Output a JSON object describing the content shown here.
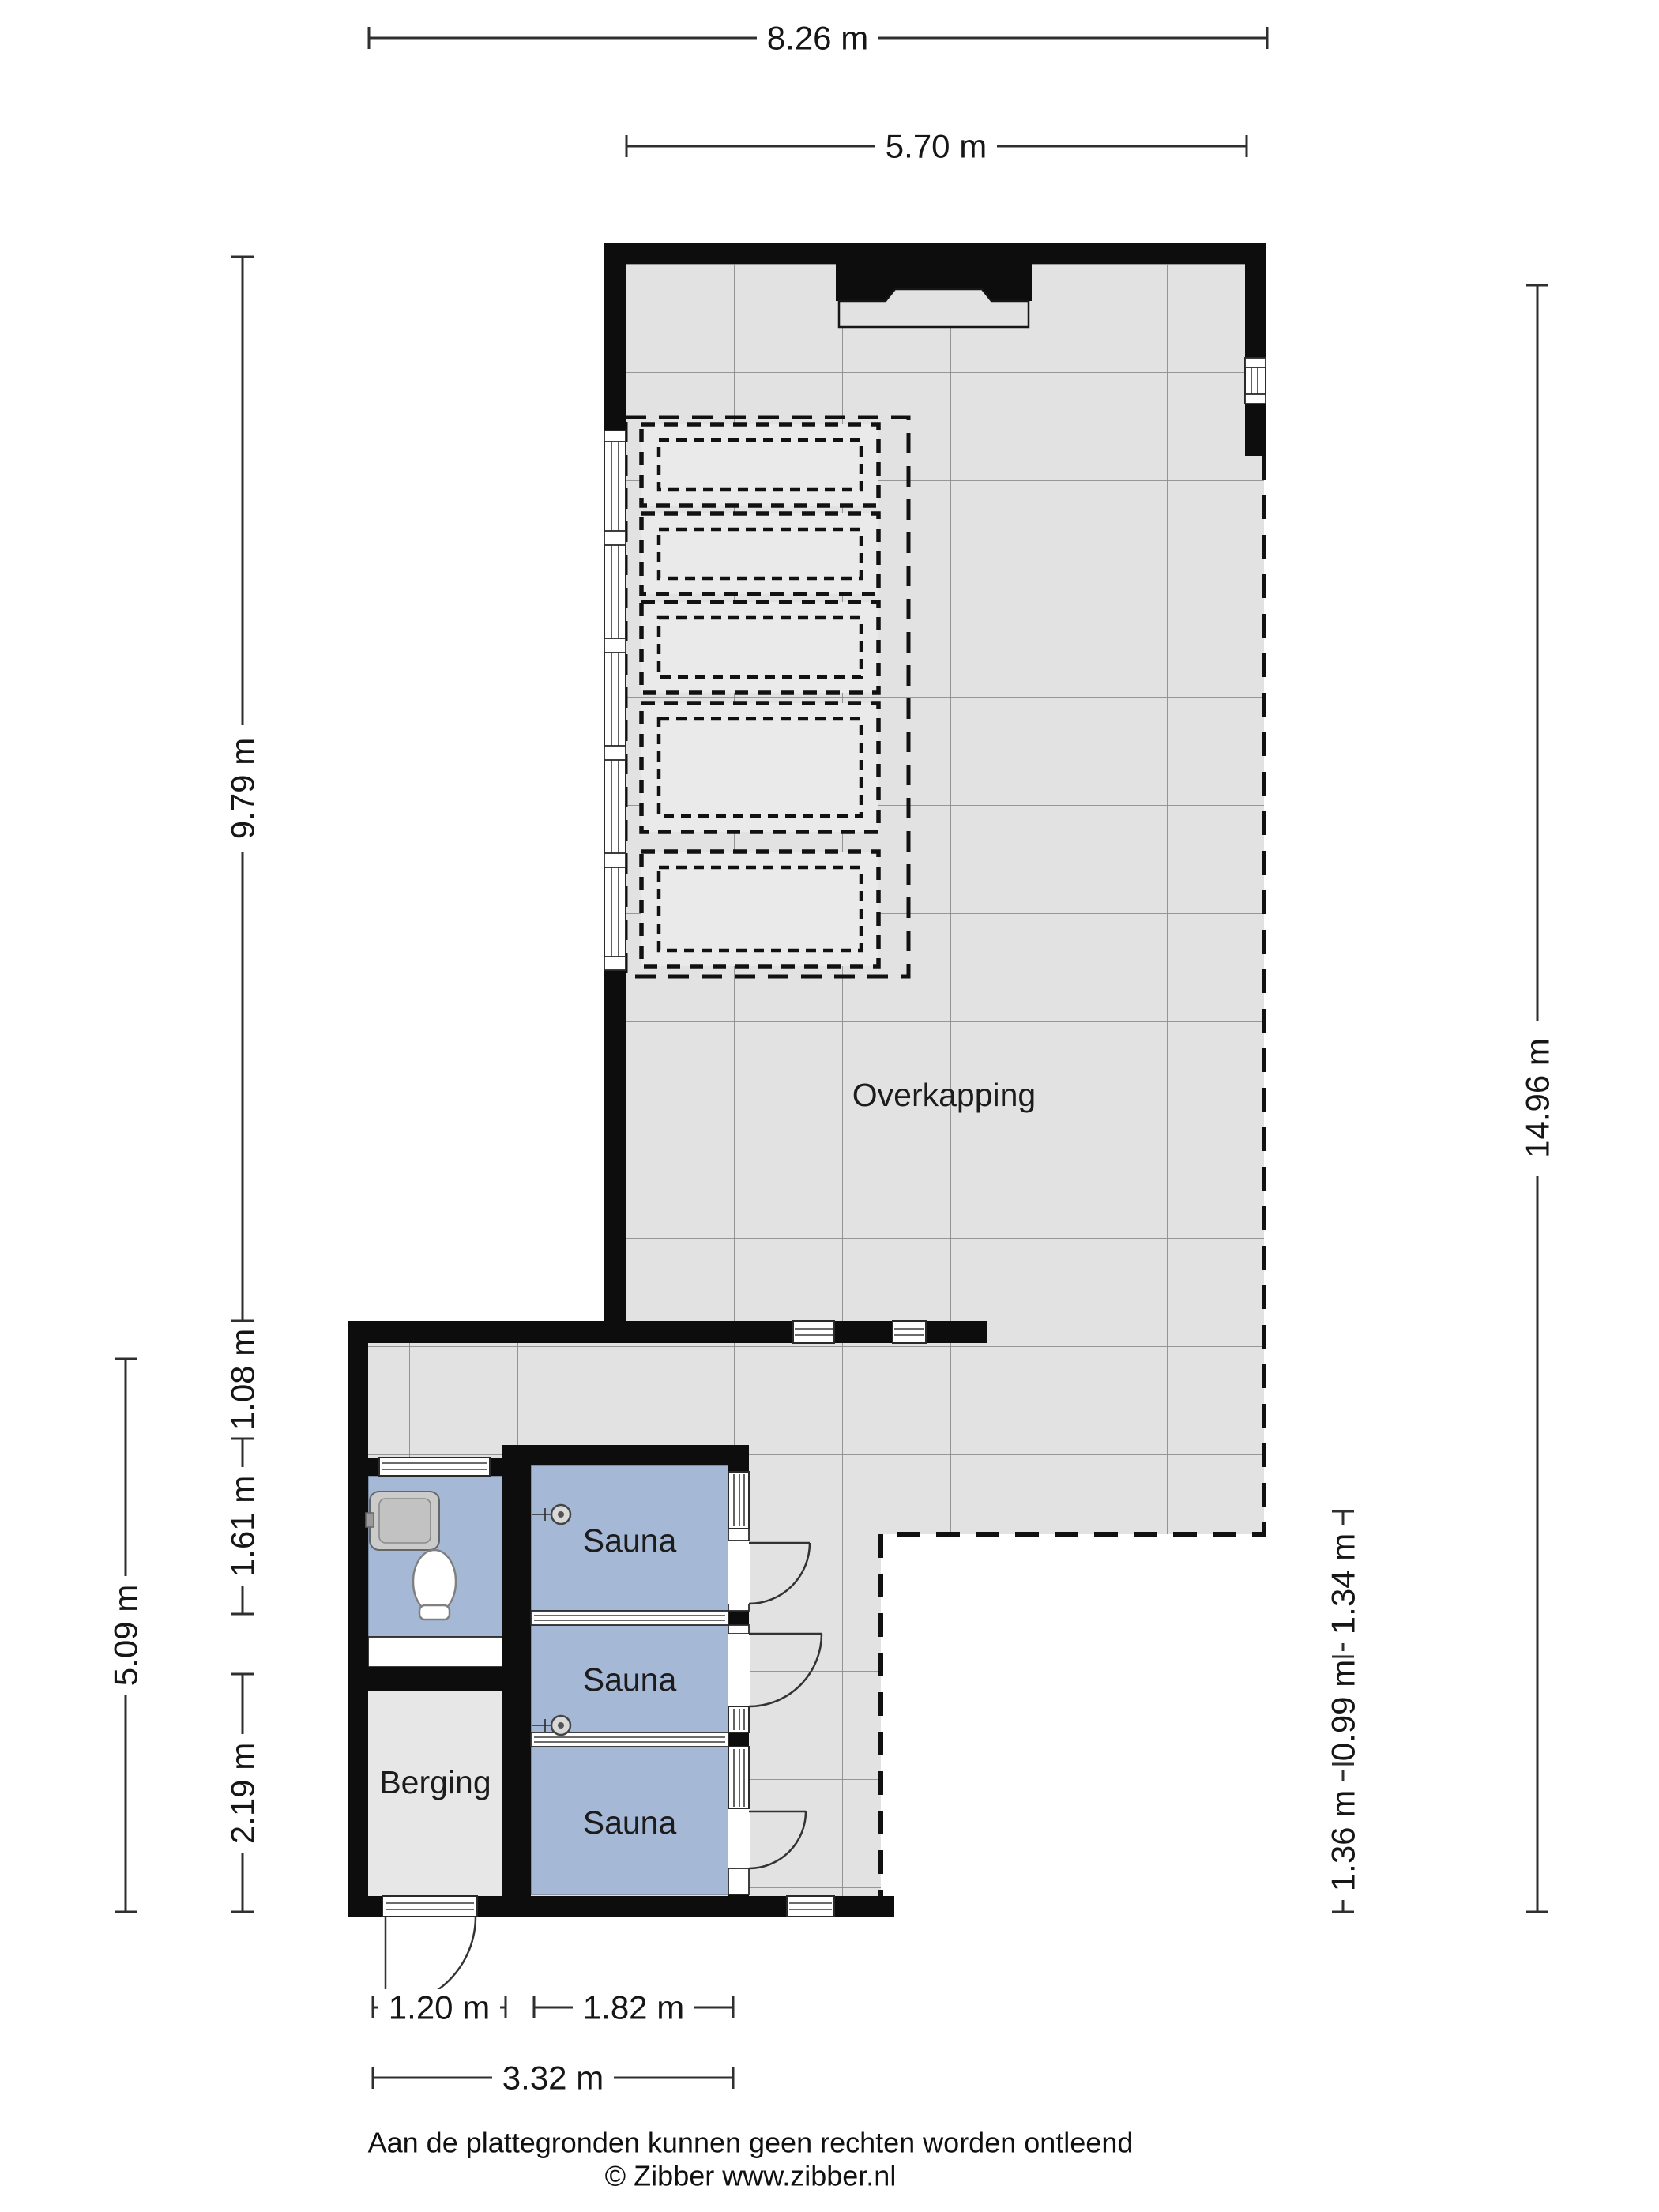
{
  "colors": {
    "wall": "#0d0d0d",
    "floor": "#e2e2e2",
    "grid_line": "#8c8c8c",
    "room_blue": "#a5b8d5",
    "berging_floor": "#e7e7e7",
    "dash": "#111111",
    "dim": "#2f2f2f"
  },
  "rooms": {
    "overkapping": "Overkapping",
    "sauna_1": "Sauna",
    "sauna_2": "Sauna",
    "sauna_3": "Sauna",
    "berging": "Berging"
  },
  "dimensions": {
    "top_total": "8.26 m",
    "top_overkapping": "5.70 m",
    "left_overkapping": "9.79 m",
    "left_annex_top": "1.08 m",
    "left_toilet": "1.61 m",
    "left_berging": "2.19 m",
    "left_annex_total": "5.09 m",
    "right_sauna_1": "1.34 m",
    "right_sauna_2": "0.99 m",
    "right_sauna_3": "1.36 m",
    "right_total": "14.96 m",
    "bottom_berging": "1.20 m",
    "bottom_sauna": "1.82 m",
    "bottom_annex_total": "3.32 m"
  },
  "footer": {
    "disclaimer": "Aan de plattegronden kunnen geen rechten worden ontleend",
    "copyright": "© Zibber www.zibber.nl"
  }
}
